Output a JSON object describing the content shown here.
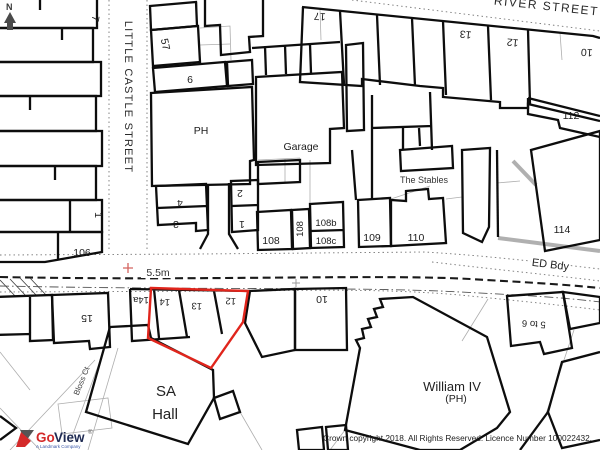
{
  "map": {
    "compass_north": "N",
    "streets": {
      "river": "RIVER STREET",
      "little_castle": "LITTLE CASTLE STREET",
      "bloss_ct": "Bloss Ct"
    },
    "road": {
      "height_marker": "5.5m",
      "ed_boundary": "ED Bdy"
    },
    "plots": {
      "p7": "7",
      "p57": "57",
      "p6": "6",
      "ph": "PH",
      "p1_west": "1",
      "p106": "106",
      "p17": "17",
      "p13_north": "13",
      "p12_north": "12",
      "p10_north": "10",
      "p112": "112",
      "p114": "114",
      "garage": "Garage",
      "stables": "The Stables",
      "p4": "4",
      "p3": "3",
      "p2": "2",
      "p1_mid": "1",
      "p108": "108",
      "p108a": "108",
      "p108b": "108b",
      "p108c": "108c",
      "p109": "109",
      "p110": "110",
      "p15": "15",
      "p14a": "14a",
      "p14": "14",
      "p13_south": "13",
      "p12_south": "12",
      "p10_south": "10",
      "p5to6": "5 to 6"
    },
    "buildings": {
      "sa_hall_line1": "SA",
      "sa_hall_line2": "Hall",
      "william_iv": "William IV",
      "william_iv_sub": "(PH)"
    }
  },
  "branding": {
    "logo_part1": "Go",
    "logo_part2": "View",
    "registered": "®",
    "tagline": "A Landmark Company"
  },
  "footer": {
    "copyright": "Crown copyright 2018. All Rights Reserved. Licence Number 100022432."
  },
  "colors": {
    "highlight_red": "#e0251c",
    "building_line": "#0d0d0d",
    "boundary_gray": "#9a9a9a",
    "bench_mark_red": "#d4645f",
    "wall_gray": "#b0b0b0",
    "logo_red": "#d42a2a",
    "logo_navy": "#1e2a52"
  }
}
